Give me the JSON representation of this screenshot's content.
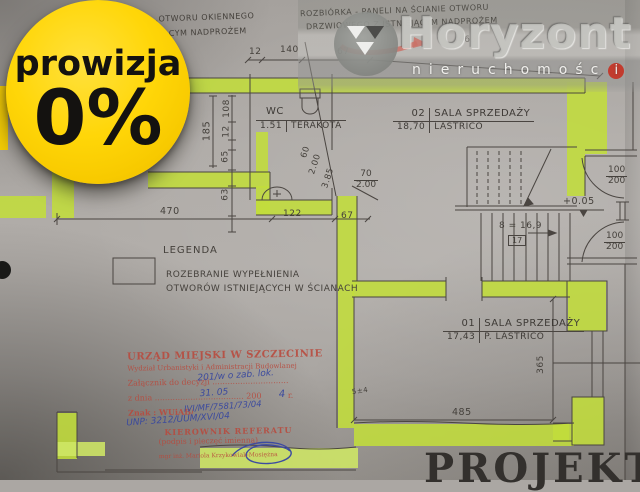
{
  "badge": {
    "line1": "prowizja",
    "line2": "0%"
  },
  "logo": {
    "title": "Horyzont",
    "subtitle": "nieruchomośc",
    "subtitle_last": "i"
  },
  "notes": {
    "tl1": "…OTWORU OKIENNEGO",
    "tl2": "…EJĄCYM NADPROŻEM",
    "tc1": "ROZBIÓRKA - PANELI NA ŚCIANIE OTWORU",
    "tc2": "DRZWIOWEGO Z ISTNIEJĄCYM NADPROŻEM"
  },
  "rooms": {
    "wc": {
      "name": "WC",
      "area": "1.51",
      "floor": "TERAKOTA"
    },
    "r02": {
      "number": "02",
      "name": "SALA SPRZEDAŻY",
      "area": "18,70",
      "floor": "LASTRICO"
    },
    "r01": {
      "number": "01",
      "name": "SALA SPRZEDAŻY",
      "area": "17,43",
      "floor": "P. LASTRICO"
    }
  },
  "legend": {
    "title": "LEGENDA",
    "line1": "ROZEBRANIE WYPEŁNIENIA",
    "line2": "OTWORÓW ISTNIEJĄCYCH W ŚCIANACH"
  },
  "dims": {
    "t12": "12",
    "t140": "140",
    "t67": "67",
    "t465": "465",
    "l185": "185",
    "l108": "108",
    "l12": "12",
    "l65": "65",
    "l63": "63",
    "m470": "470",
    "m122": "122",
    "m67": "67",
    "wcdoor_num": "70",
    "wcdoor_den": "2.00",
    "d60": "60",
    "d200": "2.00",
    "d385": "3.85",
    "door1_num": "100",
    "door1_den": "200",
    "door2_num": "100",
    "door2_den": "200",
    "level": "+0.05",
    "stairs": "8 = 16,9",
    "riser": "17",
    "v365": "365",
    "h485": "485",
    "small5": "5±4"
  },
  "stamp": {
    "l1": "URZĄD MIEJSKI W SZCZECINIE",
    "l2": "Wydział Urbanistyki i Administracji Budowlanej",
    "l3": "Załącznik do decyzji ..............................",
    "l3h": "201/w o zab. lok.",
    "l4": "z dnia ................................... 200",
    "l4b": "r.",
    "l4h": "31. 05",
    "l4h2": "4",
    "l5": "Znak : WUiAB/",
    "l5h": "IVI/MF/7581/73/04",
    "l6h": "UNP: 3212/UUM/XVI/04",
    "l7": "KIEROWNIK REFERATU",
    "l8": "(podpis i pieczęć imienna)",
    "l9": "mgr inż. Mariola Krzykowiak-Mosiężna"
  },
  "footer": {
    "projekt": "PROJEKT"
  },
  "colors": {
    "highlight_green": "#c2dd3b",
    "badge_yellow": "#ffd608",
    "stamp_red": "#b8493c",
    "logo_red": "#c23b2e",
    "pencil": "#4a4541"
  }
}
